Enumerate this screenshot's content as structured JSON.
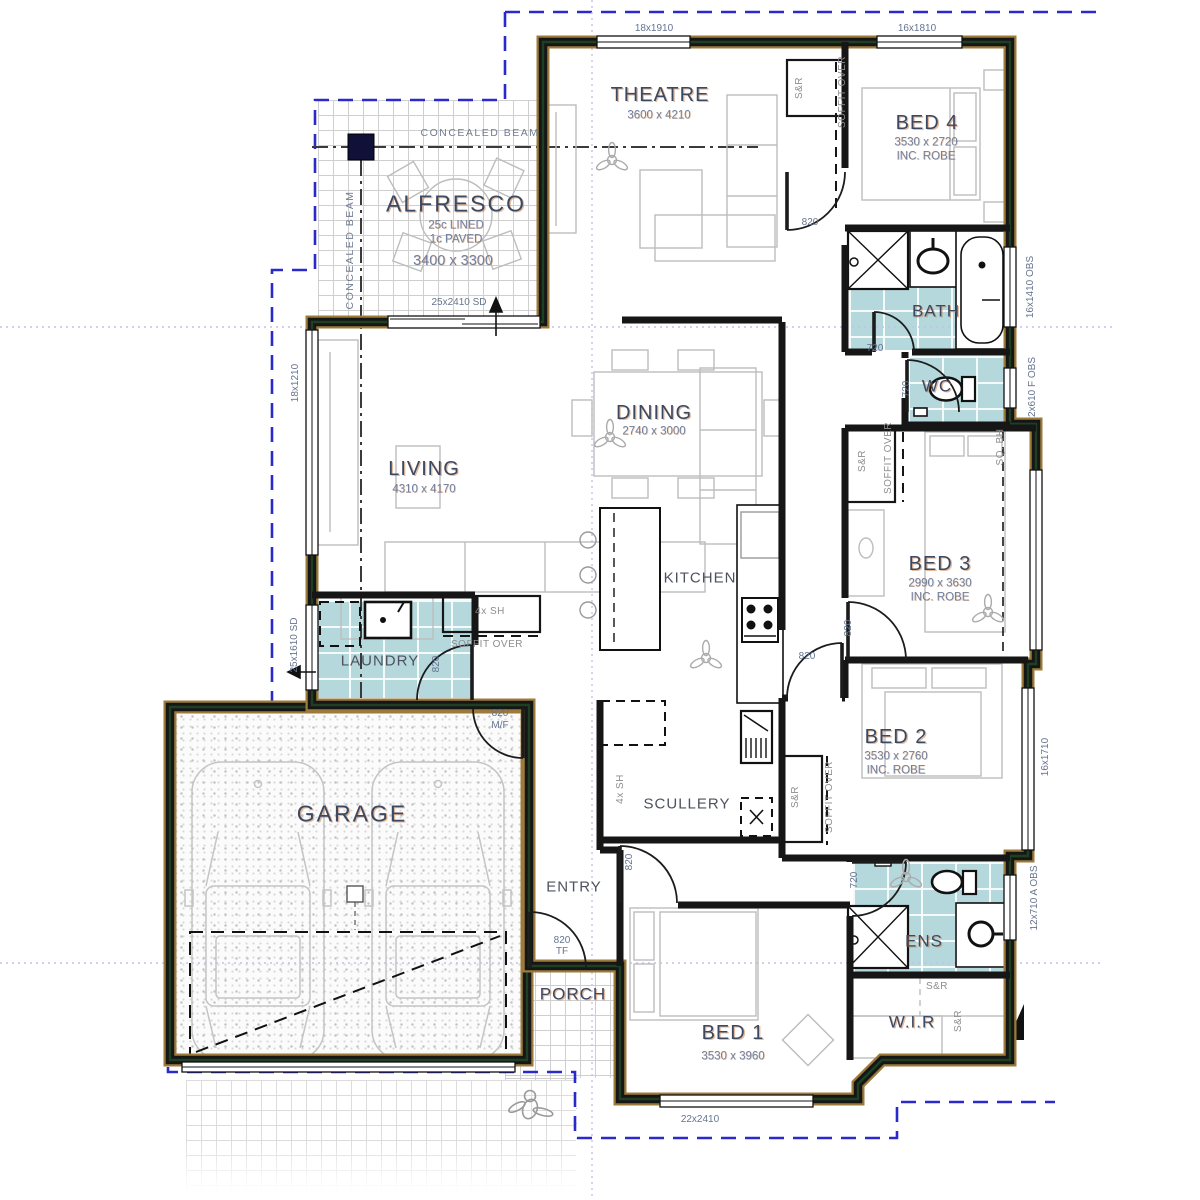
{
  "document": {
    "type": "residential floor plan"
  },
  "colors": {
    "wall_black": "#161616",
    "wall_green": "#1d4023",
    "wall_tan": "#9c7a3a",
    "wet_area_tile": "#b5d8dc",
    "boundary_dash_blue": "#2a2acc",
    "grid_dot_violet": "#c2c2ea",
    "room_label_navy": "#3c4963",
    "dim_label_slate": "#71809f",
    "furniture_gray": "#bdbdbd"
  },
  "rooms": [
    {
      "name": "THEATRE",
      "dims": "3600 x 4210"
    },
    {
      "name": "BED 4",
      "dims": "3530 x 2720",
      "note": "INC. ROBE"
    },
    {
      "name": "ALFRESCO",
      "dims": "3400 x 3300",
      "note": "25c LINED, 1c PAVED"
    },
    {
      "name": "BATH"
    },
    {
      "name": "WC"
    },
    {
      "name": "DINING",
      "dims": "2740 x 3000"
    },
    {
      "name": "LIVING",
      "dims": "4310 x 4170"
    },
    {
      "name": "KITCHEN"
    },
    {
      "name": "BED 3",
      "dims": "2990 x 3630",
      "note": "INC. ROBE"
    },
    {
      "name": "LAUNDRY"
    },
    {
      "name": "BED 2",
      "dims": "3530 x 2760",
      "note": "INC. ROBE"
    },
    {
      "name": "GARAGE"
    },
    {
      "name": "SCULLERY"
    },
    {
      "name": "ENTRY"
    },
    {
      "name": "PORCH"
    },
    {
      "name": "BED 1",
      "dims": "3530 x 3960"
    },
    {
      "name": "ENS"
    },
    {
      "name": "W.I.R"
    }
  ],
  "plan": {
    "labels": [
      {
        "t": "THEATRE",
        "x": 660,
        "y": 95,
        "c": "room",
        "n": "room-label-theatre"
      },
      {
        "t": "3600 x 4210",
        "x": 659,
        "y": 116,
        "c": "dim",
        "n": "dim-theatre"
      },
      {
        "t": "BED 4",
        "x": 927,
        "y": 123,
        "c": "room",
        "n": "room-label-bed4"
      },
      {
        "t": "3530 x 2720",
        "x": 926,
        "y": 143,
        "c": "dim",
        "n": "dim-bed4"
      },
      {
        "t": "INC. ROBE",
        "x": 926,
        "y": 157,
        "c": "dim",
        "n": "note-bed4-robe"
      },
      {
        "t": "ALFRESCO",
        "x": 456,
        "y": 204,
        "c": "room lg",
        "n": "room-label-alfresco"
      },
      {
        "t": "25c LINED",
        "x": 456,
        "y": 226,
        "c": "dim",
        "n": "note-alfresco-lined"
      },
      {
        "t": "1c PAVED",
        "x": 456,
        "y": 240,
        "c": "dim",
        "n": "note-alfresco-paved"
      },
      {
        "t": "3400 x 3300",
        "x": 453,
        "y": 261,
        "c": "dim lg2",
        "n": "dim-alfresco"
      },
      {
        "t": "BATH",
        "x": 936,
        "y": 311,
        "c": "room sm",
        "n": "room-label-bath"
      },
      {
        "t": "WC",
        "x": 937,
        "y": 386,
        "c": "room sm",
        "n": "room-label-wc"
      },
      {
        "t": "DINING",
        "x": 654,
        "y": 413,
        "c": "room",
        "n": "room-label-dining"
      },
      {
        "t": "2740 x 3000",
        "x": 654,
        "y": 432,
        "c": "dim",
        "n": "dim-dining"
      },
      {
        "t": "LIVING",
        "x": 424,
        "y": 469,
        "c": "room",
        "n": "room-label-living"
      },
      {
        "t": "4310 x 4170",
        "x": 424,
        "y": 490,
        "c": "dim",
        "n": "dim-living"
      },
      {
        "t": "BED 3",
        "x": 940,
        "y": 564,
        "c": "room",
        "n": "room-label-bed3"
      },
      {
        "t": "2990 x 3630",
        "x": 940,
        "y": 584,
        "c": "dim",
        "n": "dim-bed3"
      },
      {
        "t": "INC. ROBE",
        "x": 940,
        "y": 598,
        "c": "dim",
        "n": "note-bed3-robe"
      },
      {
        "t": "KITCHEN",
        "x": 700,
        "y": 578,
        "c": "minor",
        "n": "room-label-kitchen"
      },
      {
        "t": "LAUNDRY",
        "x": 380,
        "y": 661,
        "c": "minor",
        "n": "room-label-laundry"
      },
      {
        "t": "BED 2",
        "x": 896,
        "y": 737,
        "c": "room",
        "n": "room-label-bed2"
      },
      {
        "t": "3530 x 2760",
        "x": 896,
        "y": 757,
        "c": "dim",
        "n": "dim-bed2"
      },
      {
        "t": "INC. ROBE",
        "x": 896,
        "y": 771,
        "c": "dim",
        "n": "note-bed2-robe"
      },
      {
        "t": "GARAGE",
        "x": 352,
        "y": 814,
        "c": "room lg",
        "n": "room-label-garage"
      },
      {
        "t": "SCULLERY",
        "x": 687,
        "y": 804,
        "c": "minor",
        "n": "room-label-scullery"
      },
      {
        "t": "ENTRY",
        "x": 574,
        "y": 887,
        "c": "minor",
        "n": "room-label-entry"
      },
      {
        "t": "PORCH",
        "x": 573,
        "y": 994,
        "c": "room sm",
        "n": "room-label-porch"
      },
      {
        "t": "BED 1",
        "x": 733,
        "y": 1033,
        "c": "room",
        "n": "room-label-bed1"
      },
      {
        "t": "3530 x 3960",
        "x": 733,
        "y": 1057,
        "c": "dim",
        "n": "dim-bed1"
      },
      {
        "t": "ENS",
        "x": 924,
        "y": 941,
        "c": "room sm",
        "n": "room-label-ens"
      },
      {
        "t": "W.I.R",
        "x": 912,
        "y": 1022,
        "c": "room sm",
        "n": "room-label-wir"
      },
      {
        "t": "18x1910",
        "x": 654,
        "y": 29,
        "c": "win",
        "n": "window-label"
      },
      {
        "t": "16x1810",
        "x": 917,
        "y": 29,
        "c": "win",
        "n": "window-label"
      },
      {
        "t": "16x1410 OBS",
        "x": 1031,
        "y": 287,
        "c": "win",
        "r": 1,
        "n": "window-label"
      },
      {
        "t": "2x610 F OBS",
        "x": 1033,
        "y": 387,
        "c": "win",
        "r": 1,
        "n": "window-label"
      },
      {
        "t": "16x1710",
        "x": 1046,
        "y": 757,
        "c": "win",
        "r": 1,
        "n": "window-label"
      },
      {
        "t": "12x710 A OBS",
        "x": 1035,
        "y": 898,
        "c": "win",
        "r": 1,
        "n": "window-label"
      },
      {
        "t": "18x1210",
        "x": 296,
        "y": 383,
        "c": "win",
        "r": 1,
        "n": "window-label"
      },
      {
        "t": "25x1610 SD",
        "x": 295,
        "y": 645,
        "c": "win",
        "r": 1,
        "n": "window-label"
      },
      {
        "t": "22x2410",
        "x": 700,
        "y": 1120,
        "c": "win",
        "n": "window-label"
      },
      {
        "t": "25x2410 SD",
        "x": 459,
        "y": 303,
        "c": "win",
        "n": "window-label"
      },
      {
        "t": "CONCEALED BEAM",
        "x": 480,
        "y": 133,
        "c": "beam",
        "n": "beam-label"
      },
      {
        "t": "CONCEALED BEAM",
        "x": 350,
        "y": 250,
        "c": "beam",
        "r": 1,
        "n": "beam-label"
      },
      {
        "t": "820",
        "x": 810,
        "y": 223,
        "c": "win",
        "n": "door-label"
      },
      {
        "t": "720",
        "x": 875,
        "y": 349,
        "c": "win",
        "n": "door-label"
      },
      {
        "t": "720",
        "x": 907,
        "y": 389,
        "c": "win",
        "r": 1,
        "n": "door-label"
      },
      {
        "t": "820",
        "x": 849,
        "y": 628,
        "c": "win",
        "r": 1,
        "n": "door-label"
      },
      {
        "t": "820",
        "x": 807,
        "y": 657,
        "c": "win",
        "n": "door-label"
      },
      {
        "t": "720",
        "x": 855,
        "y": 880,
        "c": "win",
        "r": 1,
        "n": "door-label"
      },
      {
        "t": "820",
        "x": 500,
        "y": 714,
        "c": "win",
        "n": "door-label"
      },
      {
        "t": "M/F",
        "x": 500,
        "y": 726,
        "c": "win",
        "n": "door-label"
      },
      {
        "t": "820",
        "x": 437,
        "y": 664,
        "c": "win",
        "r": 1,
        "n": "door-label"
      },
      {
        "t": "820",
        "x": 630,
        "y": 862,
        "c": "win",
        "r": 1,
        "n": "door-label"
      },
      {
        "t": "820",
        "x": 562,
        "y": 941,
        "c": "win",
        "n": "door-label"
      },
      {
        "t": "TF",
        "x": 562,
        "y": 952,
        "c": "win",
        "n": "door-label"
      },
      {
        "t": "S&R",
        "x": 800,
        "y": 88,
        "c": "cl",
        "r": 1,
        "n": "closet-label"
      },
      {
        "t": "SOFFIT OVER",
        "x": 843,
        "y": 92,
        "c": "cl",
        "r": 1,
        "n": "soffit-label"
      },
      {
        "t": "S&R",
        "x": 863,
        "y": 461,
        "c": "cl",
        "r": 1,
        "n": "closet-label"
      },
      {
        "t": "SOFFIT OVER",
        "x": 889,
        "y": 458,
        "c": "cl",
        "r": 1,
        "n": "soffit-label"
      },
      {
        "t": "SQ. BH",
        "x": 1001,
        "y": 447,
        "c": "cl",
        "r": 1,
        "n": "bulkhead-label"
      },
      {
        "t": "S&R",
        "x": 796,
        "y": 797,
        "c": "cl",
        "r": 1,
        "n": "closet-label"
      },
      {
        "t": "SOFFIT OVER",
        "x": 830,
        "y": 797,
        "c": "cl",
        "r": 1,
        "n": "soffit-label"
      },
      {
        "t": "4x SH",
        "x": 490,
        "y": 612,
        "c": "cl",
        "n": "shelf-label"
      },
      {
        "t": "SOFFIT OVER",
        "x": 487,
        "y": 645,
        "c": "cl",
        "n": "soffit-label"
      },
      {
        "t": "4x SH",
        "x": 621,
        "y": 789,
        "c": "cl",
        "r": 1,
        "n": "shelf-label"
      },
      {
        "t": "S&R",
        "x": 937,
        "y": 987,
        "c": "cl",
        "n": "closet-label"
      },
      {
        "t": "S&R",
        "x": 959,
        "y": 1021,
        "c": "cl",
        "r": 1,
        "n": "closet-label"
      }
    ]
  }
}
